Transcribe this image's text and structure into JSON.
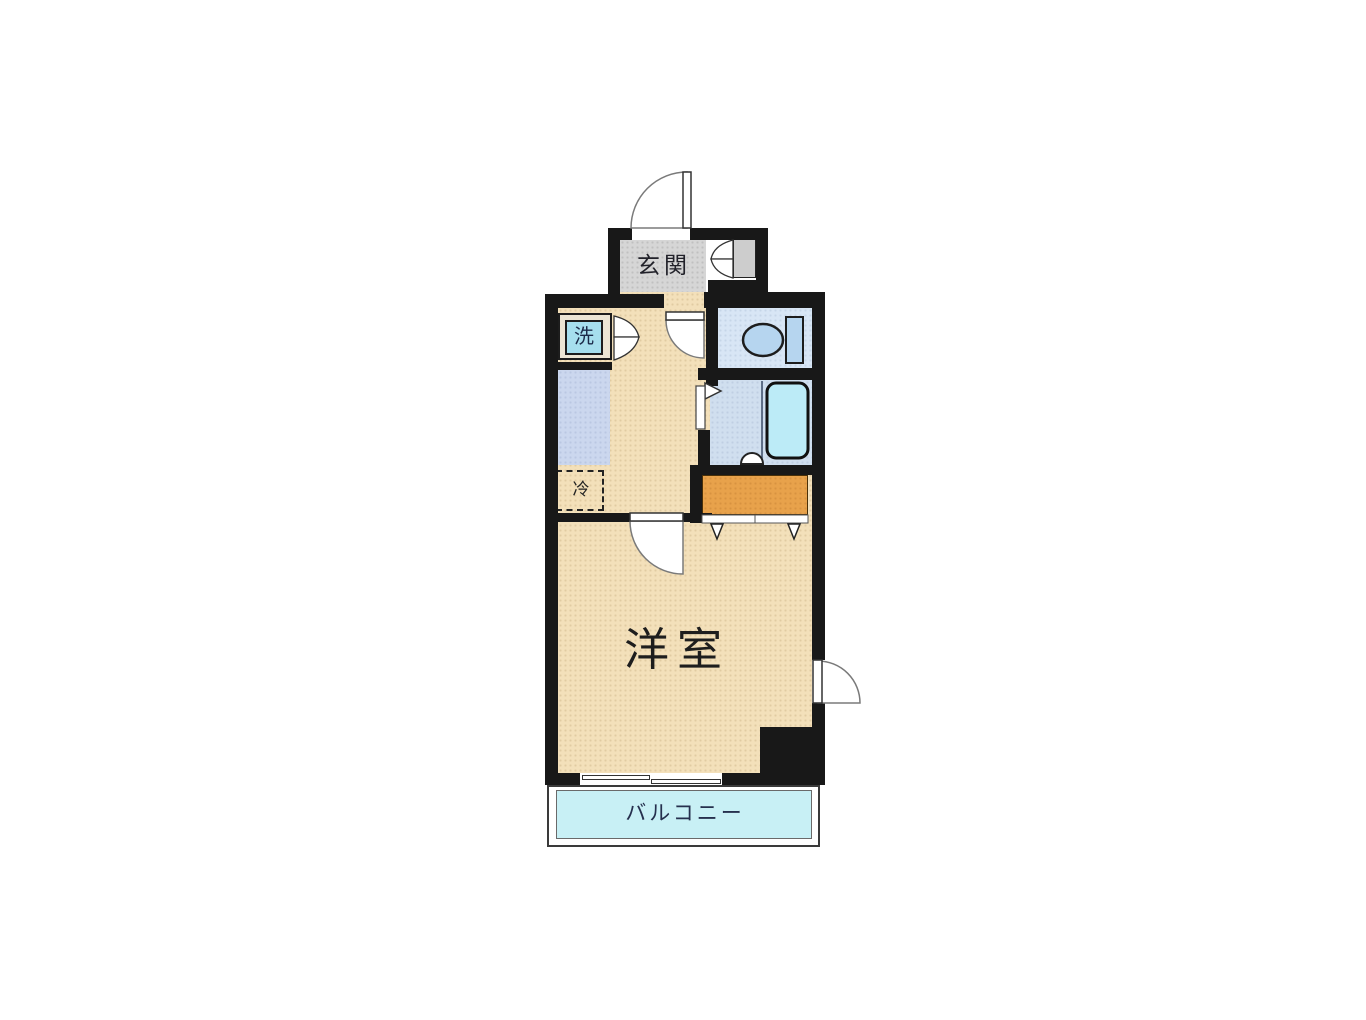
{
  "floorplan": {
    "labels": {
      "entrance": "玄関",
      "washer": "洗",
      "refrigerator": "冷",
      "western_room": "洋室",
      "balcony": "バルコニー"
    },
    "colors": {
      "wall": "#181818",
      "floor_beige": "#f3e0ba",
      "entrance_gray": "#d6d6d6",
      "kitchen_counter": "#cbd7ee",
      "sink_cyan": "#bfe7f5",
      "burner_brown": "#7d3c10",
      "toilet_room": "#d8e6f5",
      "fixture_blue": "#b6d5ef",
      "bath_room": "#d0dfef",
      "bathtub_cyan": "#bcebf7",
      "washer_cyan": "#a6dfee",
      "closet_orange": "#e8a24b",
      "balcony_cyan": "#c8f0f5",
      "label_navy": "#26304e"
    }
  }
}
